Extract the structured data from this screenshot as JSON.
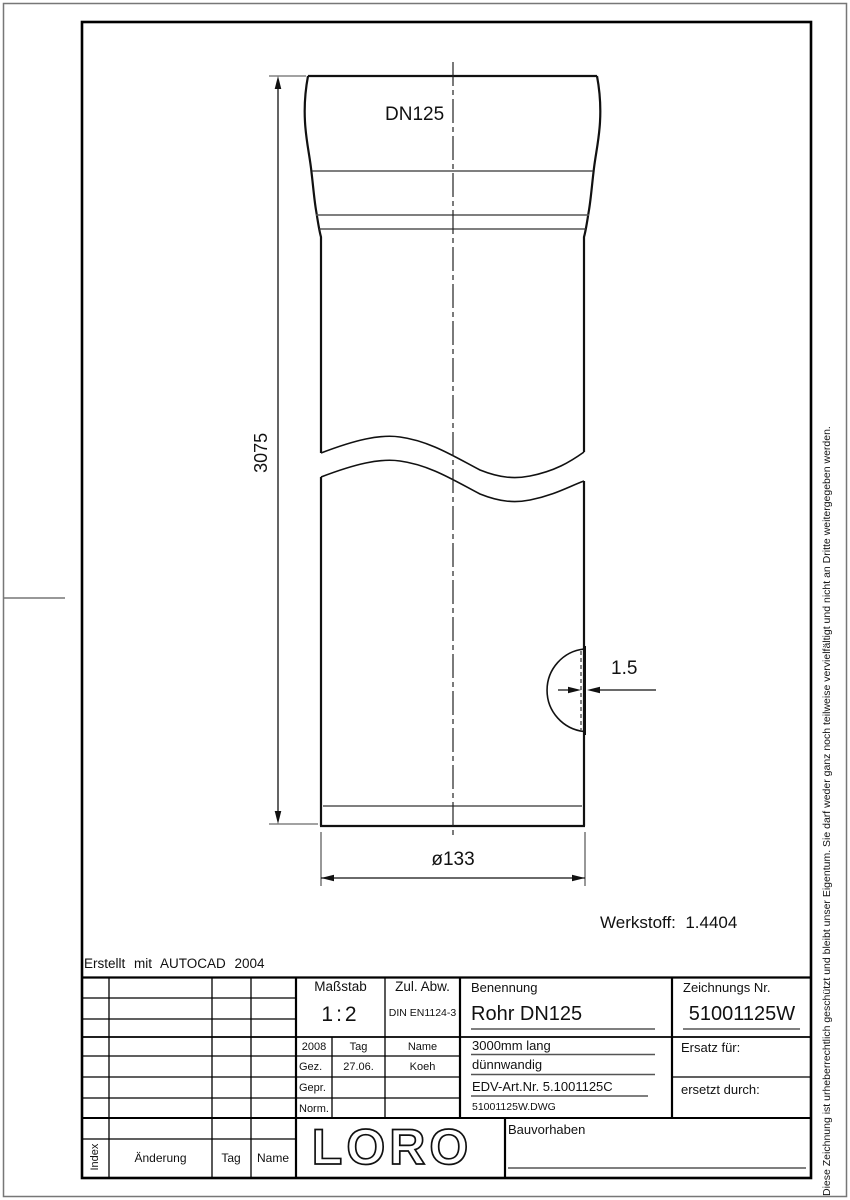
{
  "colors": {
    "background": "#ffffff",
    "line": "#111111",
    "thin_line": "#666666"
  },
  "drawing": {
    "dn_label": "DN125",
    "dim_length": "3075",
    "dim_diameter": "ø133",
    "dim_wall": "1.5",
    "material": "Werkstoff:  1.4404",
    "created_with": "Erstellt mit AUTOCAD 2004"
  },
  "copyright": "Diese Zeichnung ist urheberrechtlich geschützt und bleibt unser Eigentum. Sie darf weder ganz noch teilweise vervielfältigt und nicht an Dritte weitergegeben werden.",
  "title_block": {
    "masstab_label": "Maßstab",
    "masstab_value": "1:2",
    "zul_abw_label": "Zul. Abw.",
    "zul_abw_value": "DIN EN1124-3",
    "benennung_label": "Benennung",
    "benennung_value": "Rohr DN125",
    "zeichnungs_label": "Zeichnungs Nr.",
    "zeichnungs_value": "51001125W",
    "year": "2008",
    "col_tag": "Tag",
    "col_name": "Name",
    "gez_label": "Gez.",
    "gez_tag": "27.06.",
    "gez_name": "Koeh",
    "gepr_label": "Gepr.",
    "norm_label": "Norm.",
    "desc_line1": "3000mm lang",
    "desc_line2": "dünnwandig",
    "desc_line3": "EDV-Art.Nr. 5.1001125C",
    "desc_line4": "51001125W.DWG",
    "ersatz_label": "Ersatz für:",
    "ersetzt_label": "ersetzt durch:",
    "bauvorhaben_label": "Bauvorhaben",
    "logo": "LORO",
    "index_label": "Index",
    "aenderung_label": "Änderung",
    "tag_label": "Tag",
    "name_label": "Name"
  }
}
